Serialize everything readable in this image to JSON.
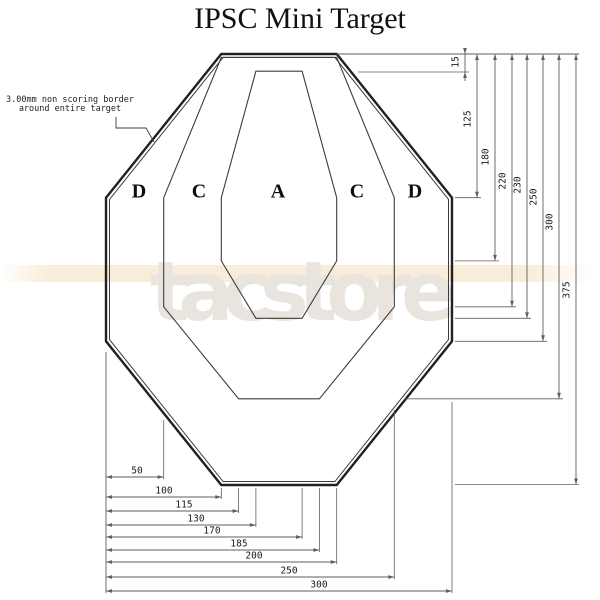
{
  "title": "IPSC Mini Target",
  "note": {
    "line1": "3.00mm non scoring border",
    "line2": "around entire target"
  },
  "watermark": "tacstore",
  "colors": {
    "target_line": "#222222",
    "inner_line": "#3c3c3c",
    "dim_line": "#5f5f5f",
    "text": "#1a1a1a",
    "watermark": "#e9e5de",
    "band": "#f8ead4"
  },
  "scale": {
    "x0": 106,
    "kx": 1.1533,
    "y0": 54,
    "ky": 1.1493
  },
  "target_mm": {
    "width": 300,
    "height": 375,
    "outer": [
      [
        100,
        0
      ],
      [
        200,
        0
      ],
      [
        300,
        125
      ],
      [
        300,
        250
      ],
      [
        200,
        375
      ],
      [
        100,
        375
      ],
      [
        0,
        250
      ],
      [
        0,
        125
      ]
    ],
    "inner_border": [
      [
        101.5,
        3
      ],
      [
        198.5,
        3
      ],
      [
        297,
        126.5
      ],
      [
        297,
        248.5
      ],
      [
        198.5,
        372
      ],
      [
        101.5,
        372
      ],
      [
        3,
        248.5
      ],
      [
        3,
        126.5
      ]
    ],
    "c_zone": [
      [
        100,
        3
      ],
      [
        200,
        3
      ],
      [
        250,
        125
      ],
      [
        250,
        220
      ],
      [
        185,
        300
      ],
      [
        115,
        300
      ],
      [
        50,
        220
      ],
      [
        50,
        125
      ]
    ],
    "a_zone": [
      [
        130,
        15
      ],
      [
        170,
        15
      ],
      [
        200,
        125
      ],
      [
        200,
        180
      ],
      [
        170,
        230
      ],
      [
        130,
        230
      ],
      [
        100,
        180
      ],
      [
        100,
        125
      ]
    ]
  },
  "zone_letters": [
    {
      "t": "D",
      "x": 139,
      "y": 193
    },
    {
      "t": "C",
      "x": 199,
      "y": 193
    },
    {
      "t": "A",
      "x": 278,
      "y": 193
    },
    {
      "t": "C",
      "x": 357,
      "y": 193
    },
    {
      "t": "D",
      "x": 415,
      "y": 193
    }
  ],
  "dims_right": {
    "baseline": {
      "x1": 336.7,
      "x2": 579,
      "y": 54
    },
    "items": [
      {
        "v": "15",
        "x": 465,
        "end": 72,
        "c1": 358,
        "c2": 469,
        "ly": 62,
        "outside": true
      },
      {
        "v": "125",
        "x": 477,
        "end": 197.7,
        "c1": 455,
        "c2": 481,
        "ly": 119
      },
      {
        "v": "180",
        "x": 495,
        "end": 260.9,
        "c1": 455,
        "c2": 499,
        "ly": 157
      },
      {
        "v": "220",
        "x": 512,
        "end": 306.8,
        "c1": 455,
        "c2": 516,
        "ly": 181
      },
      {
        "v": "230",
        "x": 527,
        "end": 318.3,
        "c1": 455,
        "c2": 531,
        "ly": 185
      },
      {
        "v": "250",
        "x": 543,
        "end": 341.3,
        "c1": 455,
        "c2": 547,
        "ly": 197
      },
      {
        "v": "300",
        "x": 559,
        "end": 398.8,
        "c1": 405,
        "c2": 563,
        "ly": 222
      },
      {
        "v": "375",
        "x": 576,
        "end": 484.5,
        "c1": 455,
        "c2": 579,
        "ly": 290
      }
    ]
  },
  "dims_bottom": {
    "baseline": {
      "x": 106,
      "y1": 352,
      "y2": 593
    },
    "items": [
      {
        "v": "50",
        "y": 477,
        "x2": 163.7,
        "lx": 137,
        "ext": [
          163.7,
          420,
          479
        ]
      },
      {
        "v": "100",
        "y": 497,
        "x2": 221.3,
        "lx": 164,
        "ext": [
          221.3,
          488,
          499
        ]
      },
      {
        "v": "115",
        "y": 511,
        "x2": 238.6,
        "lx": 184,
        "ext": [
          238.6,
          488,
          513
        ]
      },
      {
        "v": "130",
        "y": 525,
        "x2": 255.9,
        "lx": 196,
        "ext": [
          255.9,
          488,
          527
        ]
      },
      {
        "v": "170",
        "y": 537,
        "x2": 302.1,
        "lx": 212,
        "ext": [
          302.1,
          488,
          539
        ]
      },
      {
        "v": "185",
        "y": 550,
        "x2": 319.4,
        "lx": 239,
        "ext": [
          319.4,
          488,
          552
        ]
      },
      {
        "v": "200",
        "y": 562,
        "x2": 336.7,
        "lx": 254,
        "ext": [
          336.7,
          488,
          564
        ]
      },
      {
        "v": "250",
        "y": 577,
        "x2": 394.3,
        "lx": 289,
        "ext": [
          394.3,
          410,
          579
        ]
      },
      {
        "v": "300",
        "y": 591,
        "x2": 452.0,
        "lx": 319,
        "ext": [
          452.0,
          402,
          593
        ]
      }
    ]
  },
  "leader": [
    [
      116,
      117
    ],
    [
      116,
      128
    ],
    [
      146,
      128
    ],
    [
      154,
      142
    ]
  ]
}
